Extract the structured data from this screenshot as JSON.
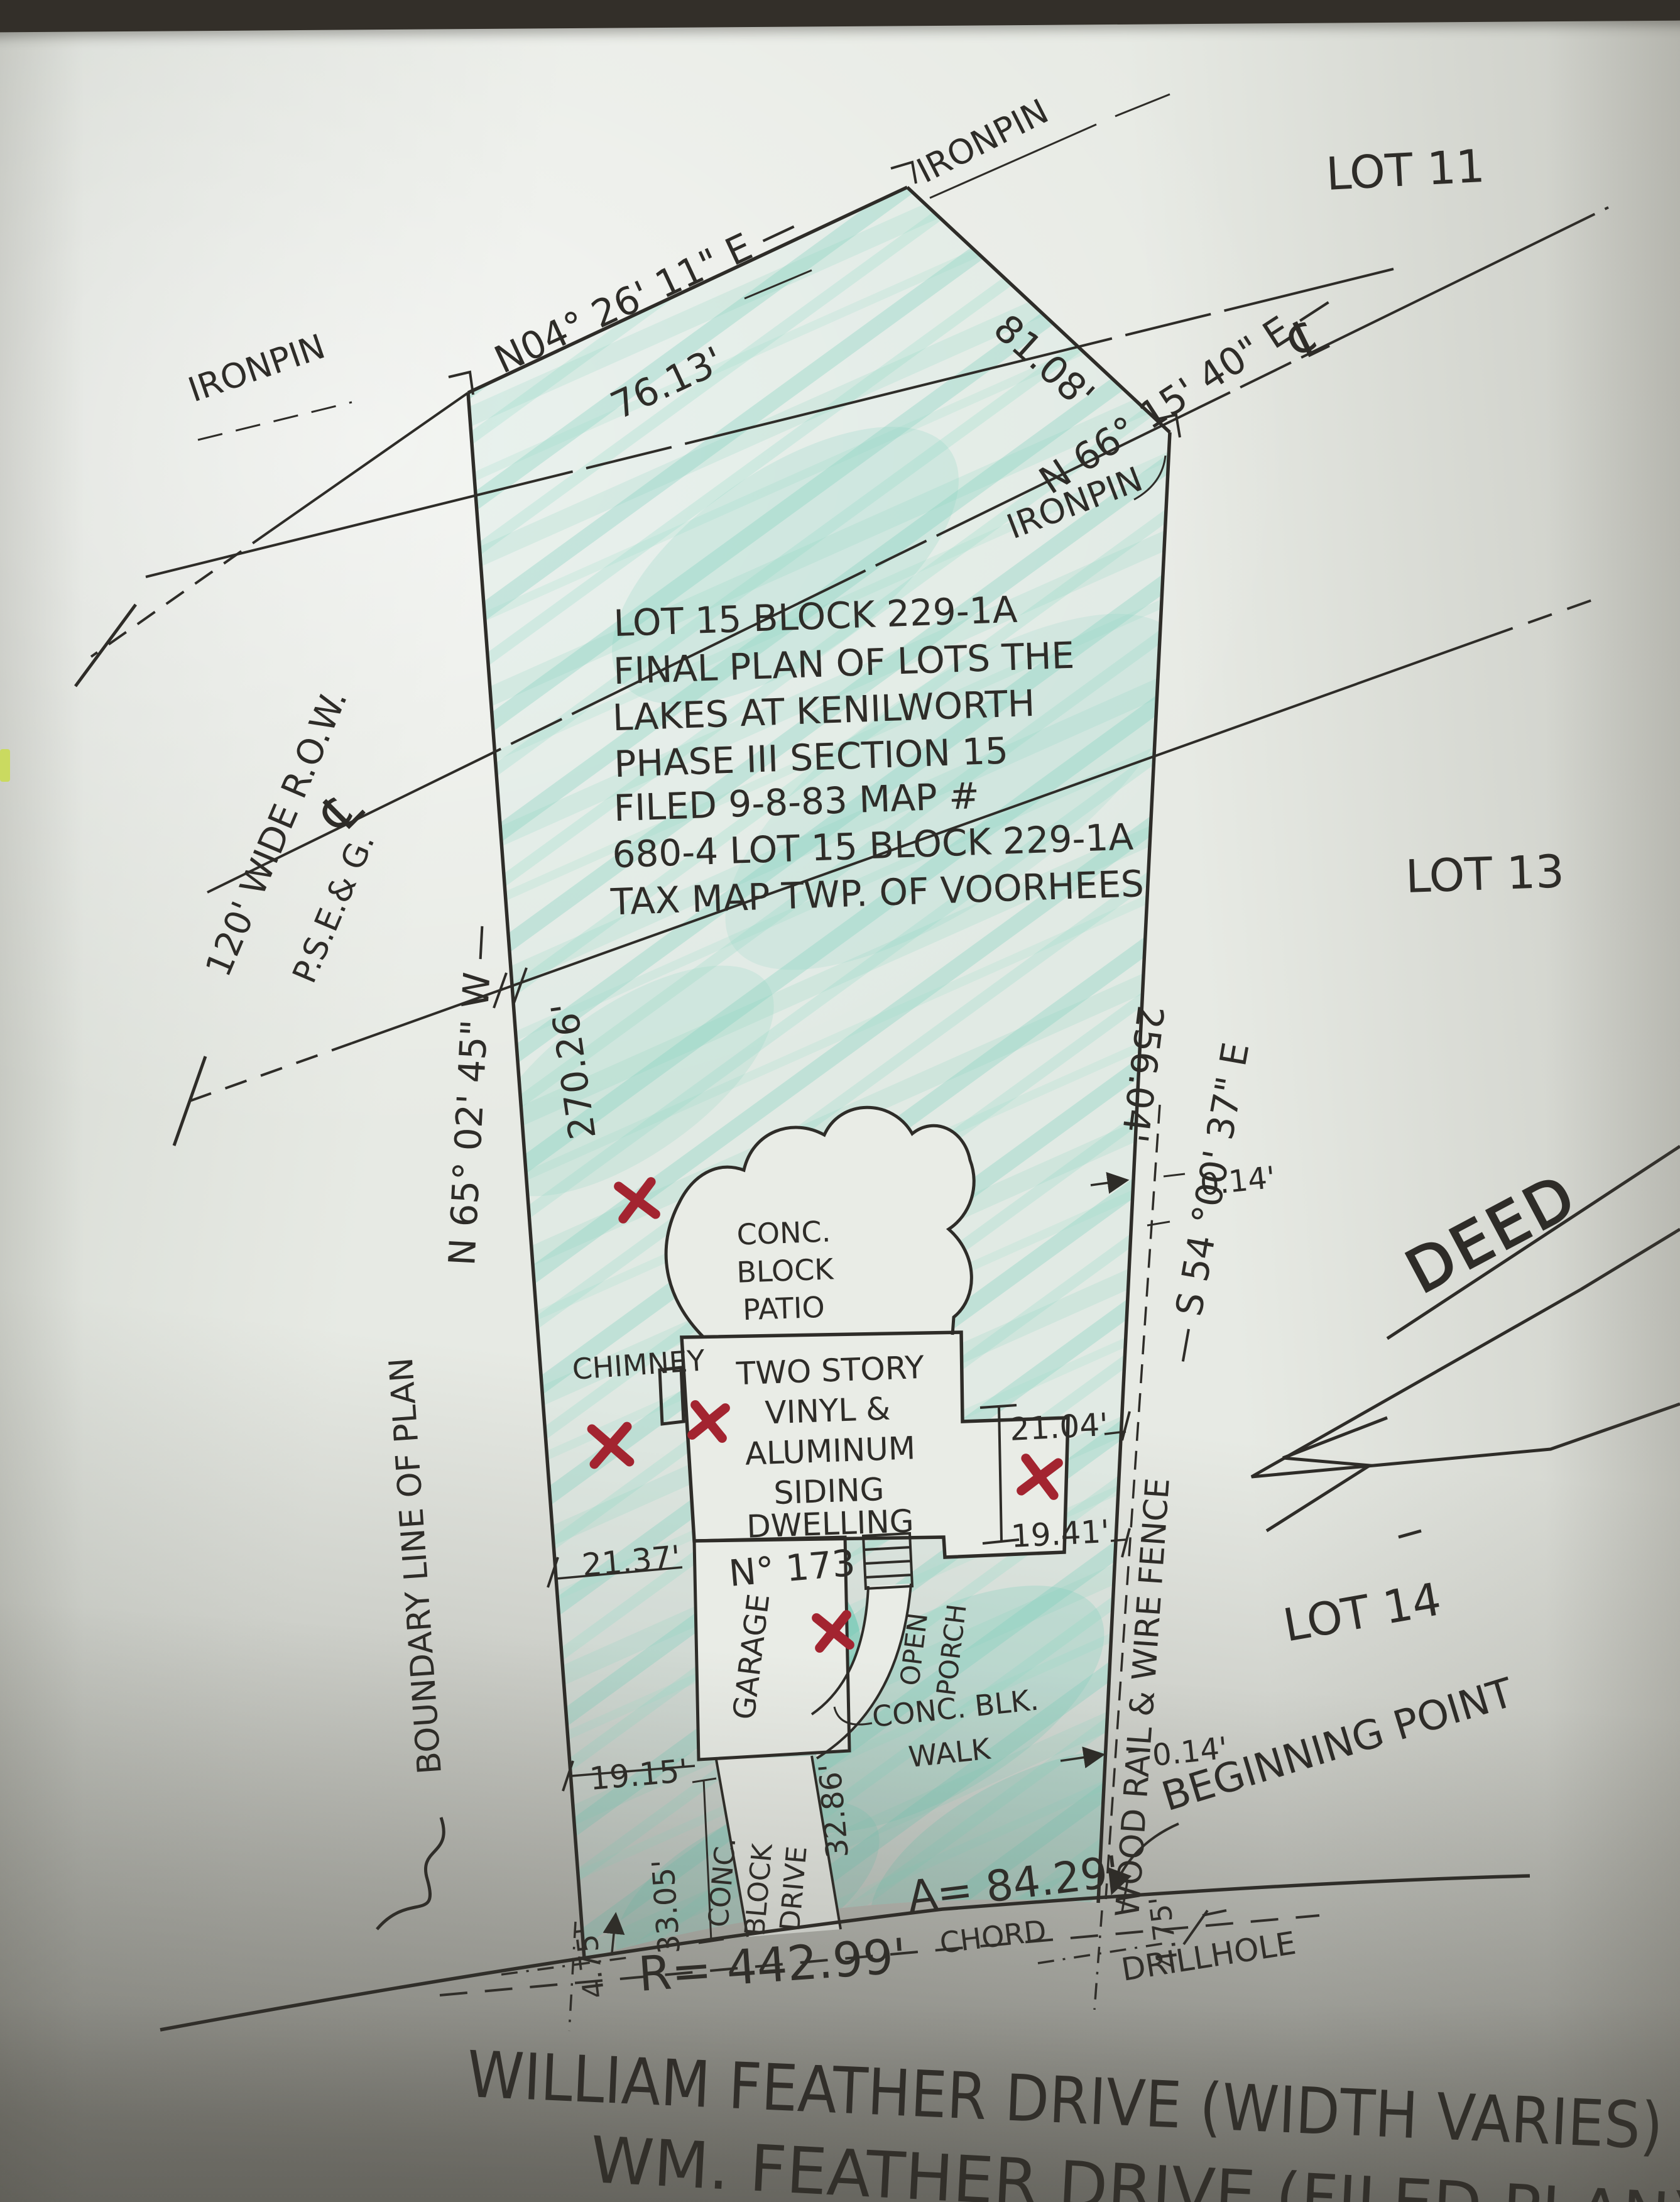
{
  "colors": {
    "ink": "#2e2c28",
    "crayon": "#7ccfbb",
    "red_mark": "#a32430",
    "paper": "#e9ece6"
  },
  "pins": {
    "top": "IRONPIN",
    "left": "IRONPIN",
    "right": "IRONPIN"
  },
  "lots": {
    "lot11": "LOT 11",
    "lot13": "LOT 13",
    "lot14": "LOT 14"
  },
  "bearings": {
    "nw_bearing": "N04° 26' 11\" E  —",
    "nw_distance": "76.13'",
    "ne_distance": "81.08'",
    "row_bearing": "N 66° 15' 40\" E —",
    "west_bearing": "N 65° 02' 45\" W —",
    "west_distance": "270.26'",
    "east_bearing": "— S 54 °00' 37\" E",
    "east_distance": "256.04'"
  },
  "row": {
    "width": "120' WIDE R.O.W.",
    "utility": "P.S.E.& G.",
    "cl": "℄"
  },
  "title_block": [
    "LOT 15 BLOCK 229-1A",
    "FINAL PLAN OF LOTS THE",
    "LAKES AT KENILWORTH",
    "PHASE III SECTION 15",
    "FILED 9-8-83 MAP #",
    "680-4  LOT 15 BLOCK 229-1A",
    "TAX MAP TWP. OF VOORHEES"
  ],
  "structures": {
    "patio": [
      "CONC.",
      "BLOCK",
      "PATIO"
    ],
    "chimney": "CHIMNEY",
    "dwelling": [
      "TWO STORY",
      "VINYL &",
      "ALUMINUM",
      "SIDING",
      "DWELLING"
    ],
    "house_number": "N° 173",
    "garage": "GARAGE",
    "porch": [
      "OPEN",
      "PORCH"
    ],
    "walk": [
      "CONC. BLK.",
      "WALK"
    ],
    "drive": [
      "CONC.",
      "BLOCK",
      "DRIVE"
    ]
  },
  "dims": {
    "wing_upper": "21.04'",
    "wing_lower": "19.41'",
    "house_left": "21.37'",
    "garage_left": "19.15'",
    "drive_left": "33.05'",
    "drive_right": "32.86'",
    "fence_offset_upper": "0.14'",
    "fence_offset_lower": "0.14'",
    "curve_offset_left": "4.75'",
    "curve_offset_right": "4.75'",
    "arc": "A= 84.29'",
    "radius": "R= 442.99'",
    "chord": "CHORD"
  },
  "annotations": {
    "fence": "WOOD RAIL & WIRE FENCE",
    "boundary_line": "BOUNDARY LINE OF PLAN",
    "beginning_point": "BEGINNING POINT",
    "drill_hole": "DRILLHOLE",
    "deed": "DEED"
  },
  "street": {
    "line1": "WILLIAM FEATHER DRIVE (WIDTH VARIES)",
    "line2": "WM. FEATHER DRIVE (FILED PLAN)"
  }
}
